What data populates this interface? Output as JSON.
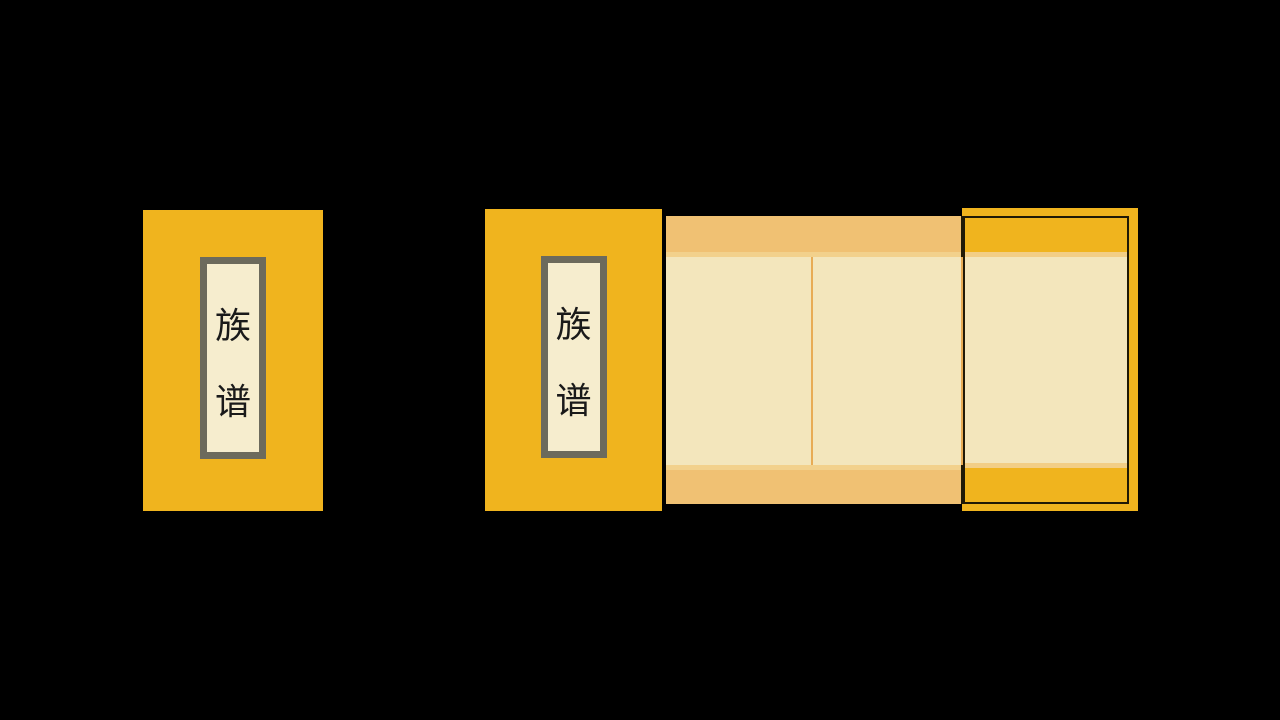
{
  "colors": {
    "background": "#000000",
    "cover-gold": "#F0B41E",
    "band-tan": "#F0C173",
    "page-cream": "#F3E6BC",
    "stripe-light": "#F2D18C",
    "stripe-gold-page": "#F2CE86",
    "divider-orange": "#E8AC55",
    "label-cream": "#F6EDCE",
    "frame-gray": "#6C6A5C",
    "outline-dark": "#201A06",
    "text-ink": "#1A1A1A"
  },
  "closed_book": {
    "label": {
      "chars": [
        "族",
        "谱"
      ]
    }
  },
  "open_book": {
    "front_label": {
      "chars": [
        "族",
        "谱"
      ]
    },
    "page_count": 3
  }
}
